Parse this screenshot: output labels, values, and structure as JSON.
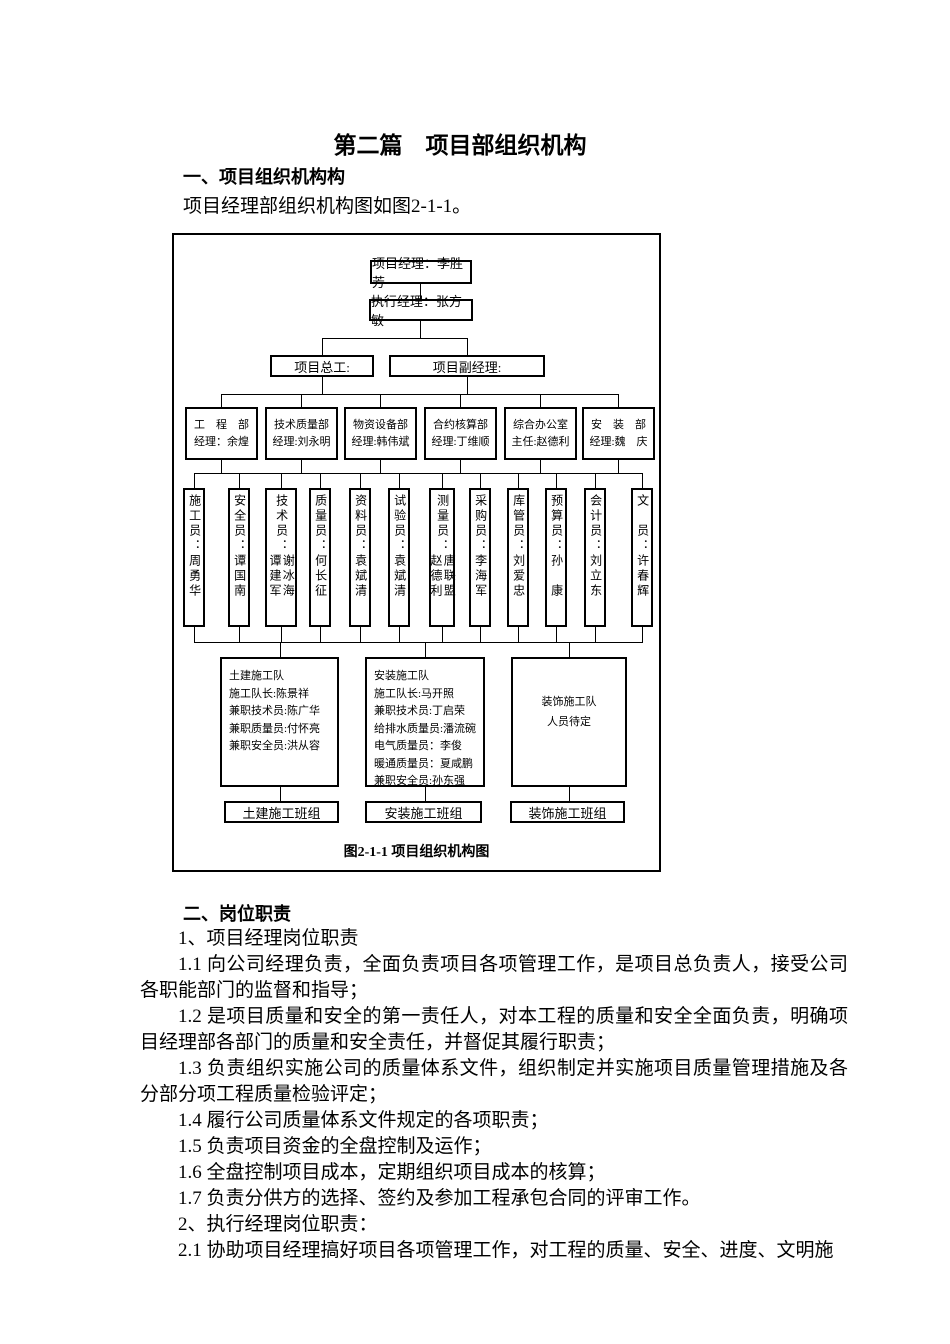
{
  "page": {
    "title": "第二篇　项目部组织机构",
    "section1_heading": "一、项目组织机构构",
    "section1_intro": "项目经理部组织机构图如图2-1-1。",
    "section2_heading": "二、岗位职责"
  },
  "chart": {
    "caption": "图2-1-1 项目组织机构图",
    "project_manager": "项目经理：李胜芳",
    "executive_manager": "执行经理：张方敏",
    "chief_engineer": "项目总工:",
    "deputy_manager": "项目副经理:",
    "departments": [
      {
        "line1": "工　程　部",
        "line2": "经理：余煌"
      },
      {
        "line1": "技术质量部",
        "line2": "经理:刘永明"
      },
      {
        "line1": "物资设备部",
        "line2": "经理:韩伟斌"
      },
      {
        "line1": "合约核算部",
        "line2": "经理:丁维顺"
      },
      {
        "line1": "综合办公室",
        "line2": "主任:赵德利"
      },
      {
        "line1": "安　装　部",
        "line2": "经理:魏　庆"
      }
    ],
    "staff": [
      {
        "title": "施工员：",
        "name1": "周勇华"
      },
      {
        "title": "安全员：",
        "name1": "谭国南"
      },
      {
        "title": "技术员：",
        "name1": "谭建军",
        "name2": "谢冰海"
      },
      {
        "title": "质量员：",
        "name1": "何长征"
      },
      {
        "title": "资料员：",
        "name1": "袁斌清"
      },
      {
        "title": "试验员：",
        "name1": "袁斌清"
      },
      {
        "title": "测量员：",
        "name1": "赵德利",
        "name2": "唐联盟"
      },
      {
        "title": "采购员：",
        "name1": "李海军"
      },
      {
        "title": "库管员：",
        "name1": "刘爱忠"
      },
      {
        "title": "预算员：",
        "name1": "孙　康"
      },
      {
        "title": "会计员：",
        "name1": "刘立东"
      },
      {
        "title": "文　员：",
        "name1": "许春辉"
      }
    ],
    "teams": [
      {
        "lines": [
          "土建施工队",
          "施工队长:陈景祥",
          "兼职技术员:陈广华",
          "兼职质量员:付怀亮",
          "兼职安全员:洪从容"
        ]
      },
      {
        "lines": [
          "安装施工队",
          "施工队长:马开照",
          "兼职技术员:丁启荣",
          "给排水质量员:潘流碗",
          "电气质量员：李俊",
          "暖通质量员：夏咸鹏",
          "兼职安全员:孙东强"
        ]
      },
      {
        "lines": [
          "装饰施工队",
          "人员待定"
        ]
      }
    ],
    "crews": [
      "土建施工班组",
      "安装施工班组",
      "装饰施工班组"
    ]
  },
  "duties": {
    "paragraphs": [
      "1、项目经理岗位职责",
      "1.1 向公司经理负责，全面负责项目各项管理工作，是项目总负责人，接受公司各职能部门的监督和指导；",
      "1.2 是项目质量和安全的第一责任人，对本工程的质量和安全全面负责，明确项目经理部各部门的质量和安全责任，并督促其履行职责；",
      "1.3 负责组织实施公司的质量体系文件，组织制定并实施项目质量管理措施及各分部分项工程质量检验评定；",
      "1.4 履行公司质量体系文件规定的各项职责；",
      "1.5 负责项目资金的全盘控制及运作；",
      "1.6 全盘控制项目成本，定期组织项目成本的核算；",
      "1.7 负责分供方的选择、签约及参加工程承包合同的评审工作。",
      "2、执行经理岗位职责：",
      "2.1 协助项目经理搞好项目各项管理工作，对工程的质量、安全、进度、文明施"
    ]
  }
}
